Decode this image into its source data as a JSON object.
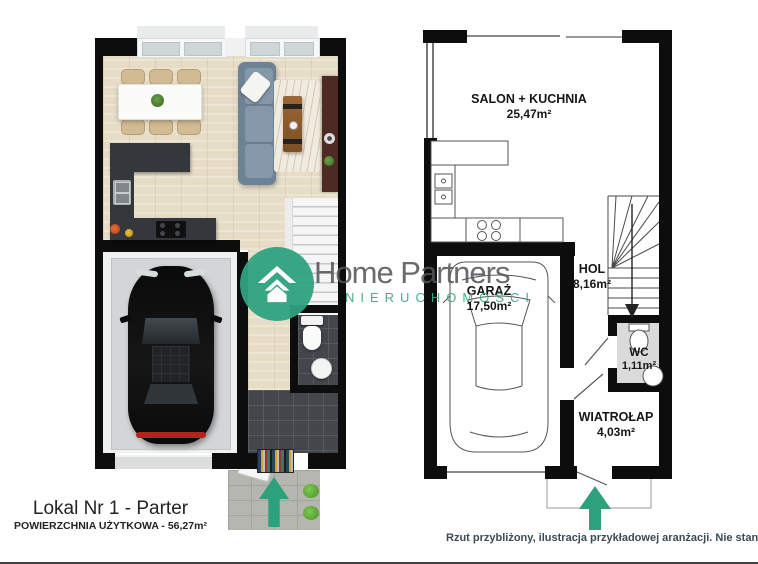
{
  "watermark": {
    "brand": "Home Partners",
    "subtitle": "NIERUCHOMOŚCI"
  },
  "right_plan": {
    "rooms": [
      {
        "label": "SALON + KUCHNIA",
        "area": "25,47m²"
      },
      {
        "label": "GARAŻ",
        "area": "17,50m²"
      },
      {
        "label": "HOL",
        "area": "8,16m²"
      },
      {
        "label": "WC",
        "area": "1,11m²"
      },
      {
        "label": "WIATROŁAP",
        "area": "4,03m²"
      }
    ]
  },
  "footer": {
    "unit_title": "Lokal Nr 1 - Parter",
    "usable_area": "POWIERZCHNIA UŻYTKOWA - 56,27m²",
    "disclaimer": "Rzut przybliżony, ilustracja przykładowej aranżacji. Nie stanowi oferty handlowej."
  },
  "colors": {
    "accent_green": "#2da17c",
    "wall_black": "#0d0d0d",
    "wc_fill": "#dadada"
  }
}
